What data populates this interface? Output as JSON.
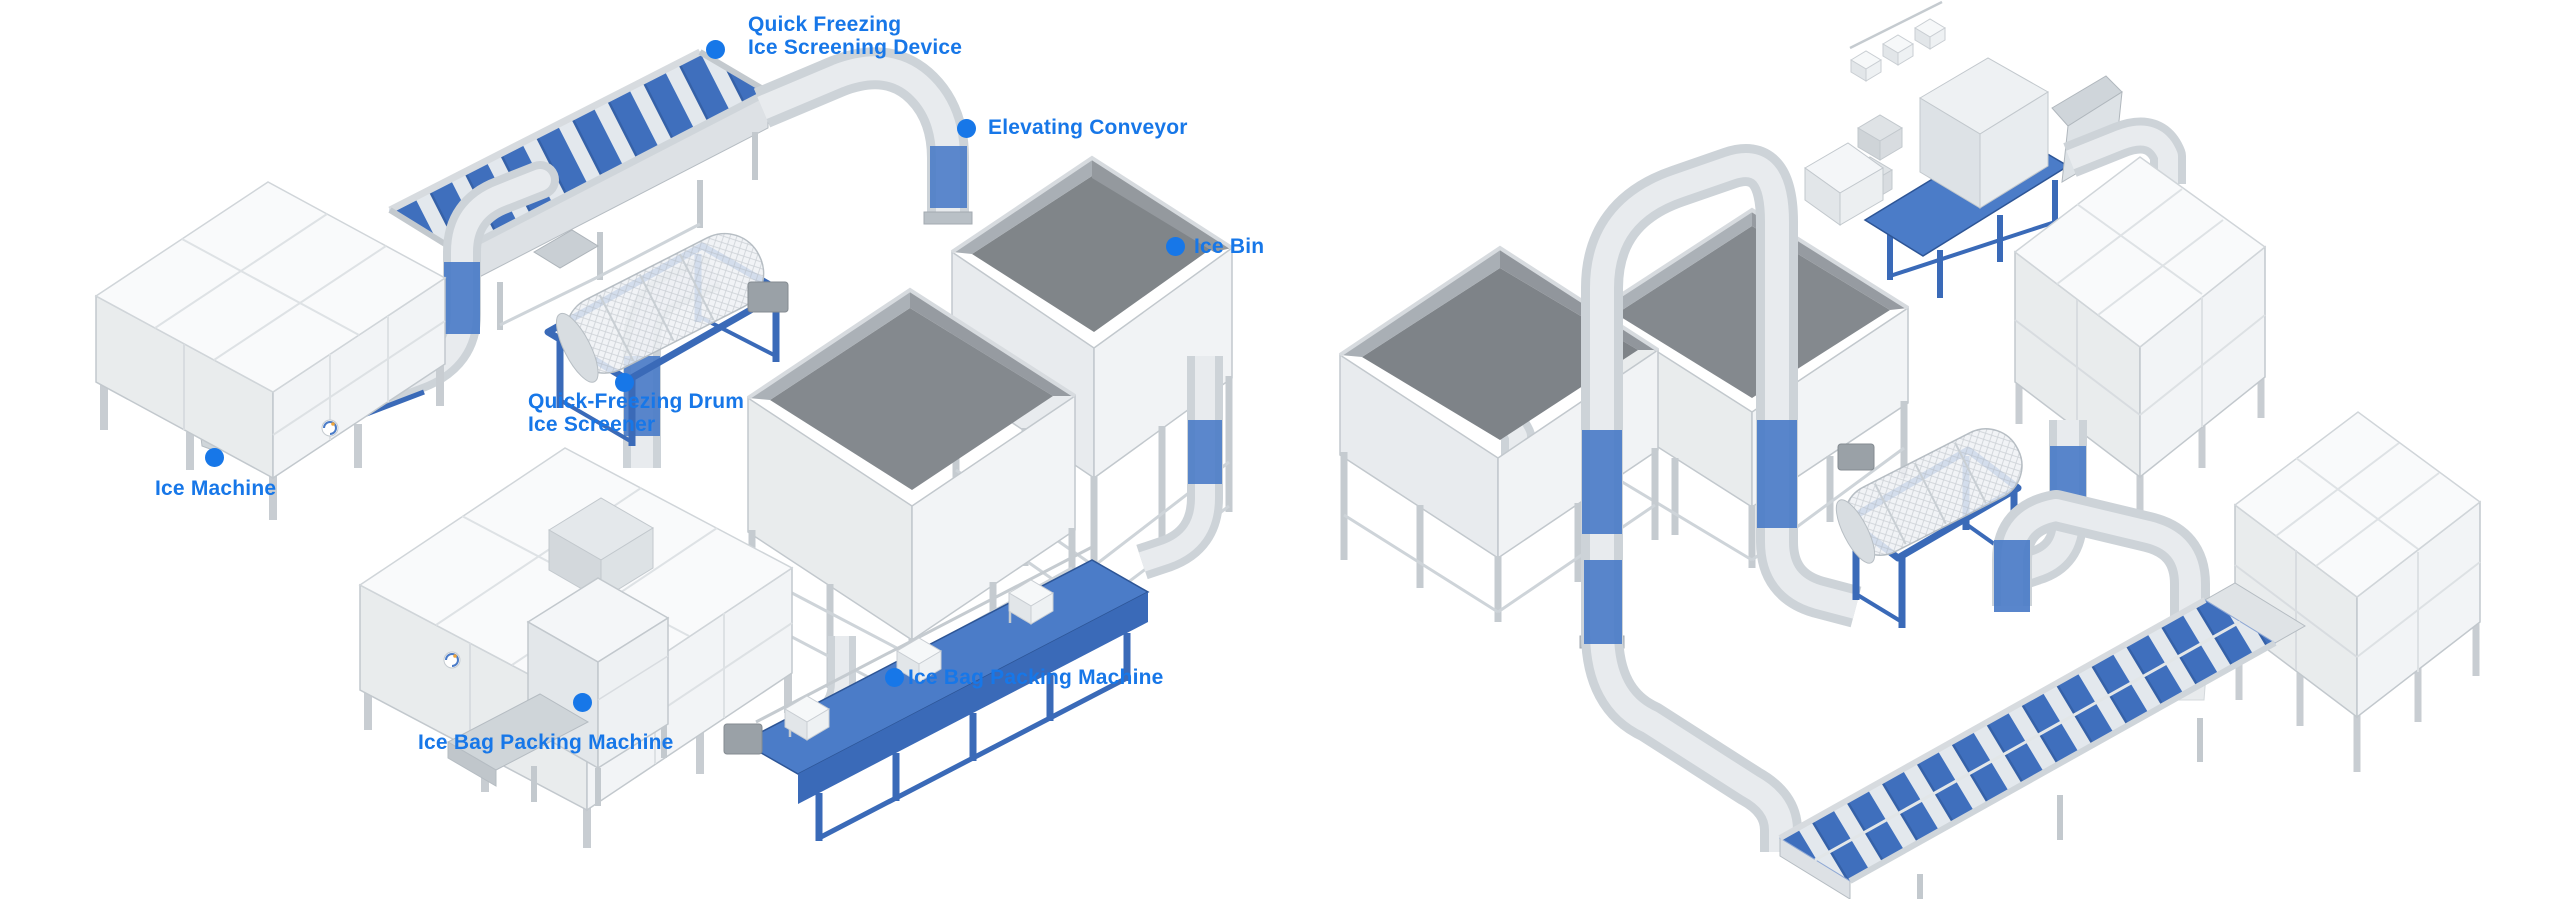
{
  "scene": {
    "title": "Ice production line diagram",
    "background": "#ffffff",
    "accent_blue": "#1777e8",
    "machine_blue": "#3f6fbd",
    "frame_blue": "#3a6ab8",
    "steel_gray": "#cdd3d8"
  },
  "left_diagram": {
    "labels": [
      {
        "id": "quick-freezing-ice-screening-device",
        "lines": [
          "Quick Freezing",
          "Ice Screening Device"
        ]
      },
      {
        "id": "elevating-conveyor",
        "lines": [
          "Elevating Conveyor"
        ]
      },
      {
        "id": "ice-bin",
        "lines": [
          "Ice Bin"
        ]
      },
      {
        "id": "quick-freezing-drum-ice-screener",
        "lines": [
          "Quick-Freezing Drum",
          "Ice Screener"
        ]
      },
      {
        "id": "ice-machine",
        "lines": [
          "Ice Machine"
        ]
      },
      {
        "id": "ice-bag-packing-machine-left",
        "lines": [
          "Ice Bag Packing Machine"
        ]
      },
      {
        "id": "ice-bag-packing-machine-right",
        "lines": [
          "Ice Bag Packing Machine"
        ]
      }
    ]
  },
  "right_diagram": {
    "labels": []
  }
}
